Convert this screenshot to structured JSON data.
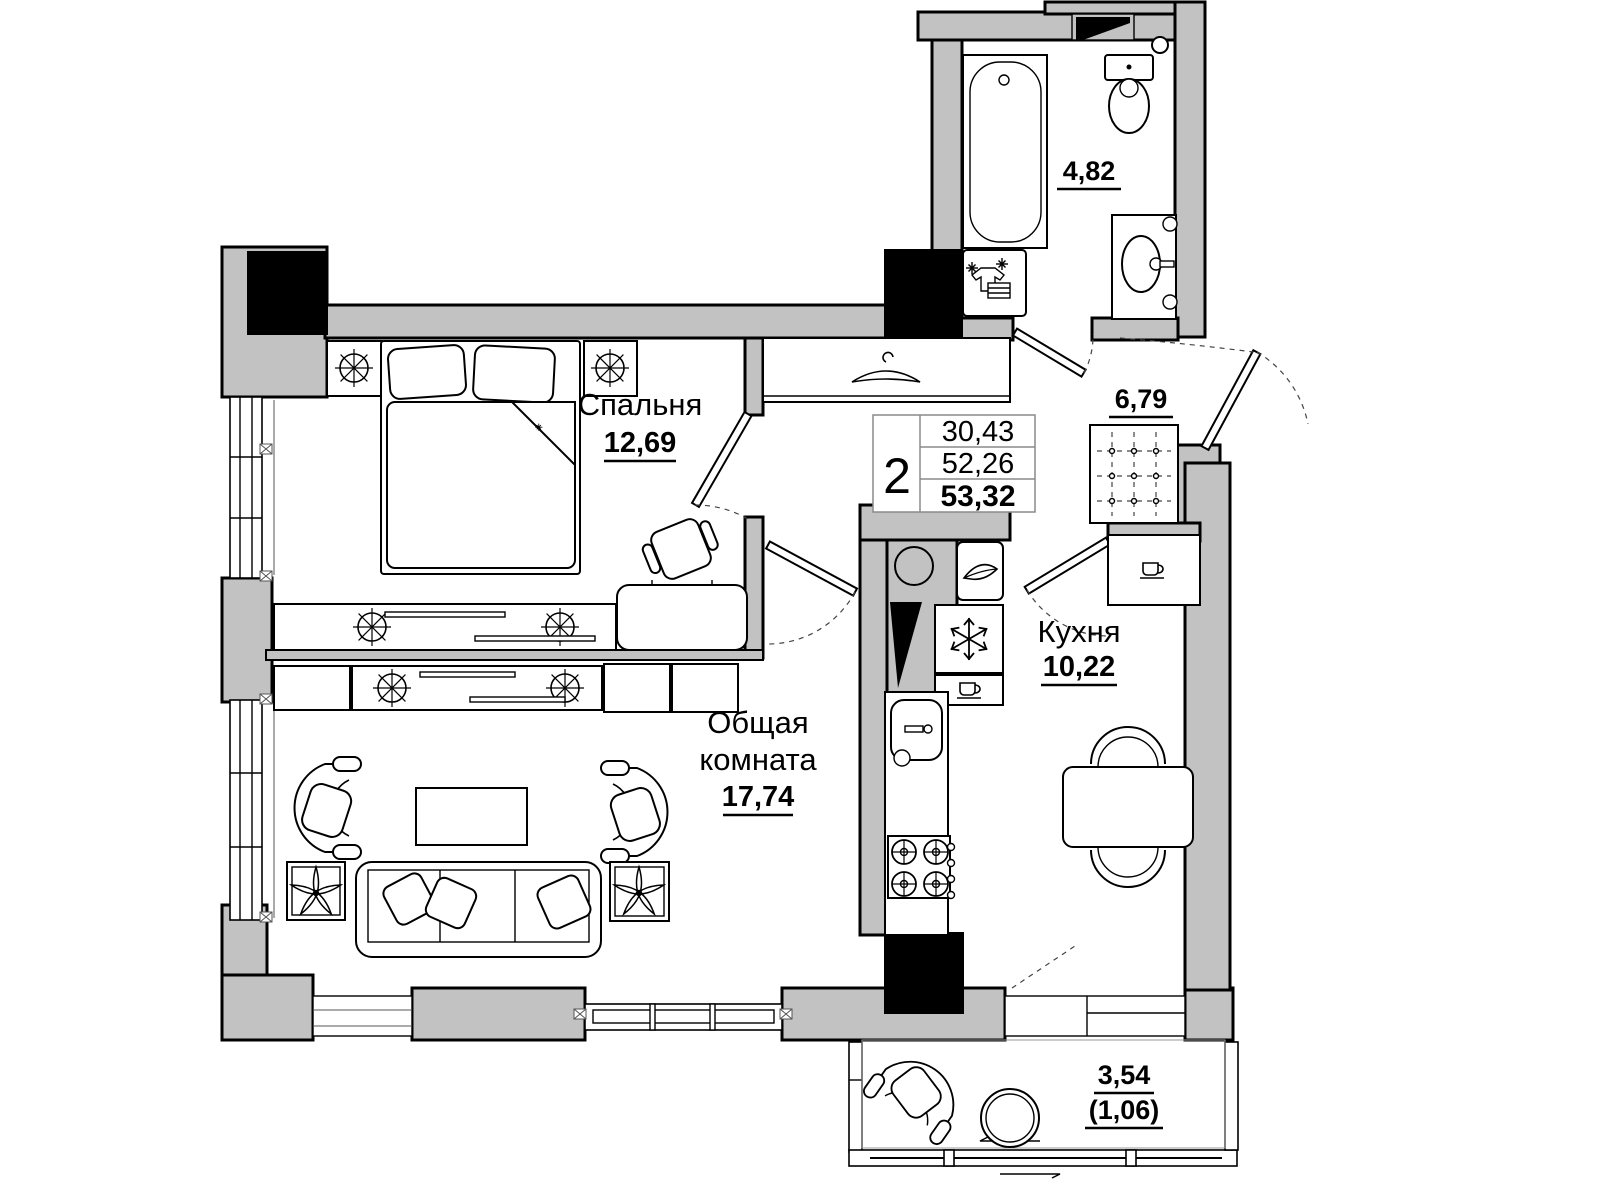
{
  "plan": {
    "rooms": {
      "bedroom": {
        "name": "Спальня",
        "area": "12,69"
      },
      "living_room": {
        "name_line1": "Общая",
        "name_line2": "комната",
        "area": "17,74"
      },
      "kitchen": {
        "name": "Кухня",
        "area": "10,22"
      },
      "bathroom": {
        "area": "4,82"
      },
      "hallway": {
        "area": "6,79"
      },
      "balcony": {
        "area": "3,54",
        "area_coefficient": "(1,06)"
      }
    },
    "info_table": {
      "room_count": "2",
      "living_area": "30,43",
      "floor_area": "52,26",
      "total_area": "53,32"
    },
    "colors": {
      "wall_fill": "#c2c2c2",
      "shaft_fill": "#000000",
      "line": "#000000",
      "background": "#ffffff"
    }
  }
}
